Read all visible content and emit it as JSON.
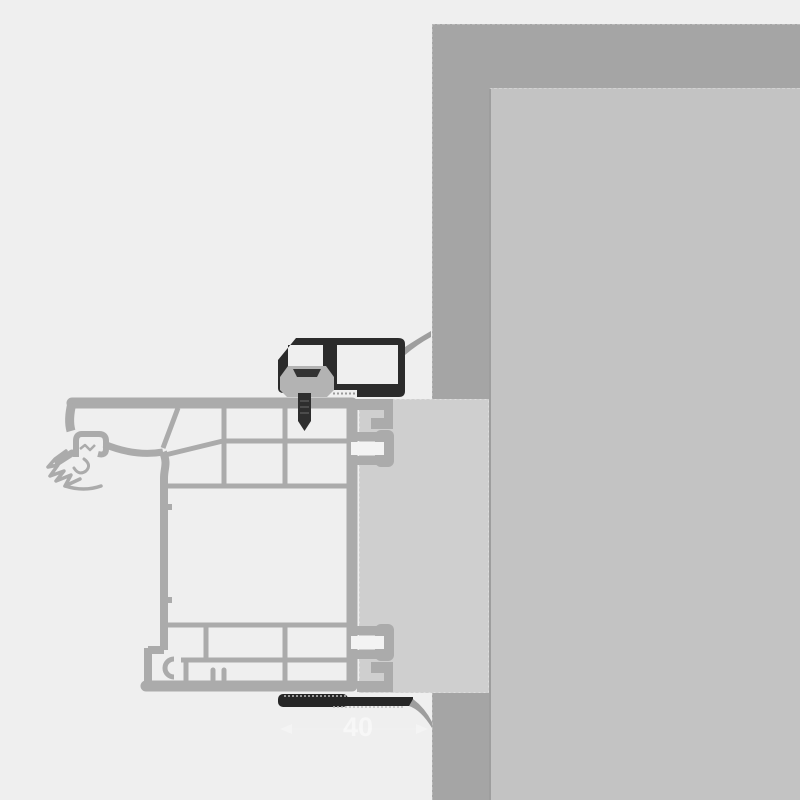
{
  "annotation": {
    "dimension_value": "40"
  },
  "colors": {
    "background": "#efefef",
    "wall_outer": "#a5a5a5",
    "wall_inner": "#c3c3c3",
    "wall_edge_line": "#9e9e9e",
    "filler_panel": "#cfcfcf",
    "profile": "#ababab",
    "trim_dark": "#2b2b2b",
    "trim_bottom_dark": "#262626",
    "clip_gray": "#b3b3b3",
    "clip_hatch": "#333333",
    "screw_dark": "#2e2e2e",
    "slot_white": "#f3f3f3",
    "swoosh_gray": "#9e9e9e",
    "tape_dash": "#9a9a9a",
    "watermark_white": "#ffffff"
  }
}
